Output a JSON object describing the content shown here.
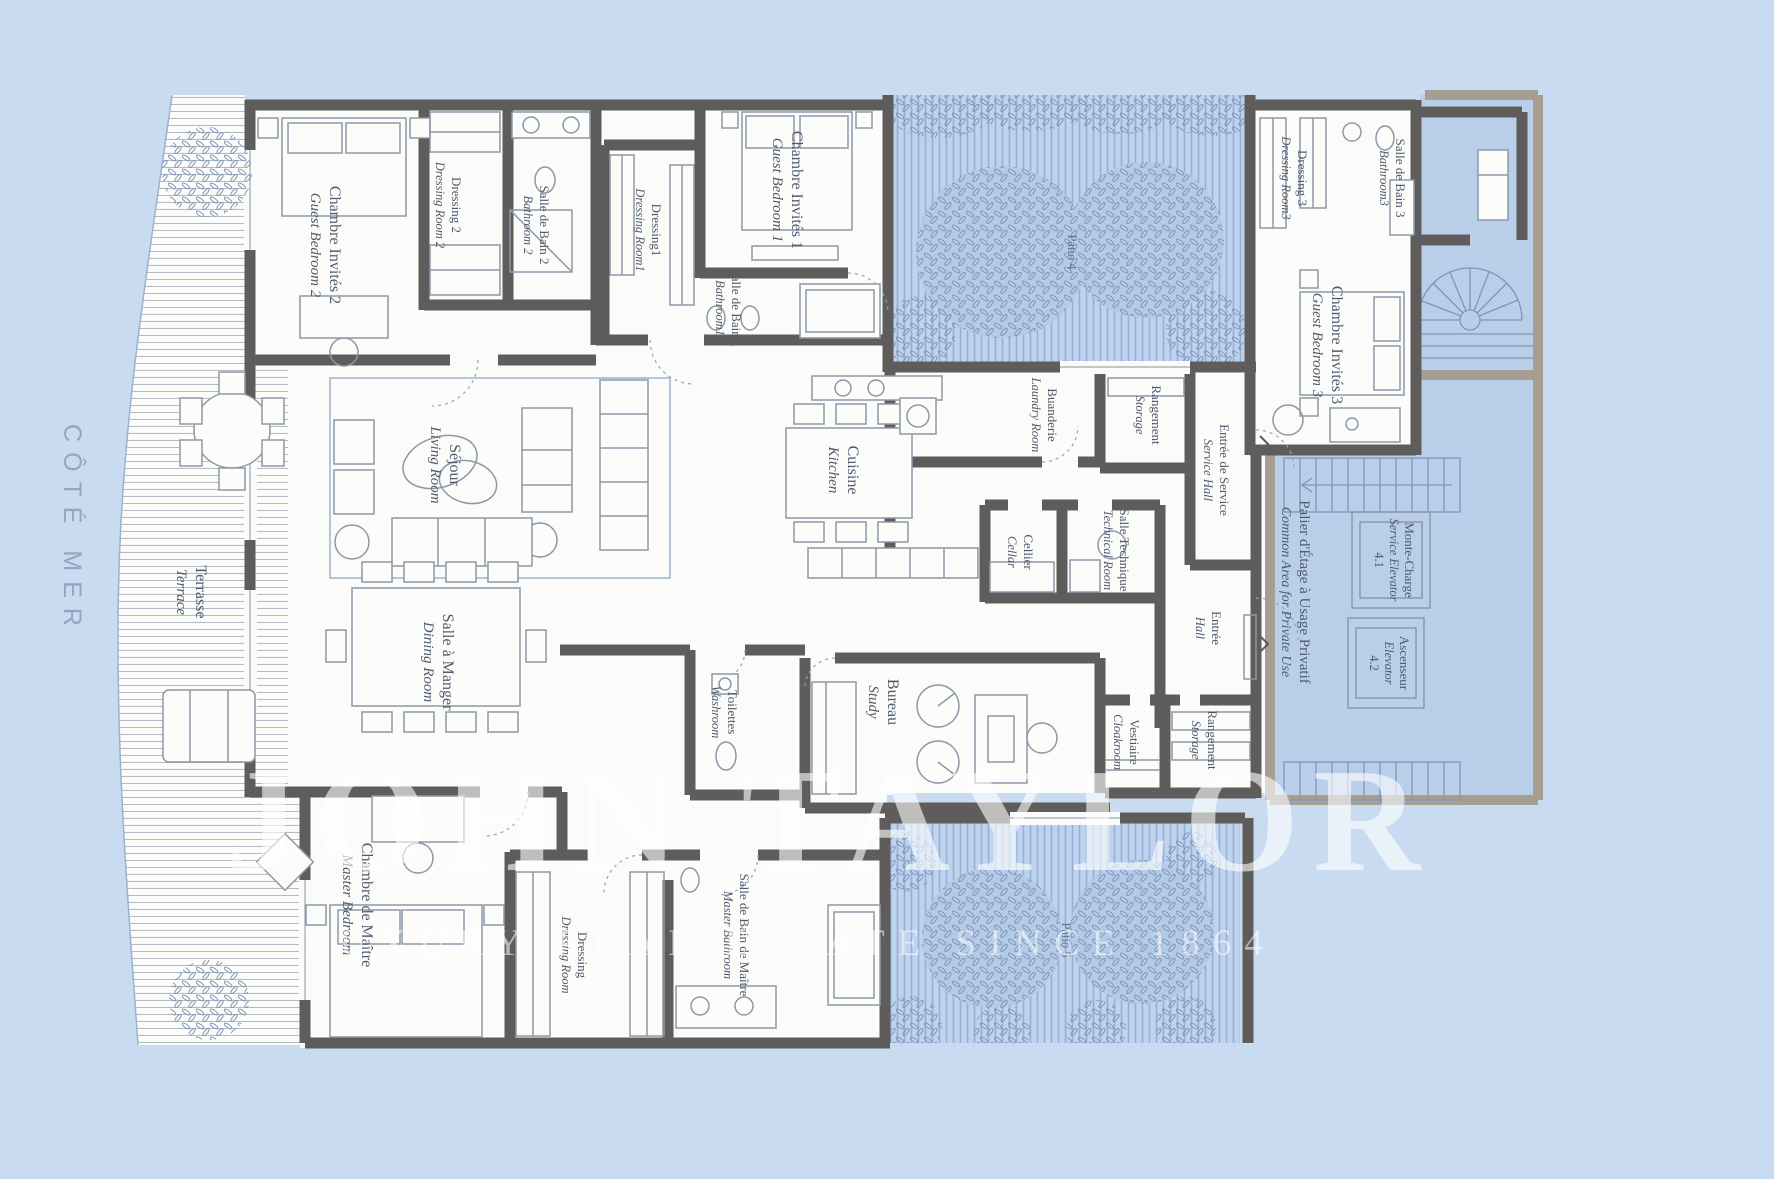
{
  "side_label": "CÔTÉ MER",
  "watermark": {
    "brand": "JOHN TAYLOR",
    "tagline": "LUXURY REAL ESTATE SINCE 1864"
  },
  "terrace": {
    "fr": "Terrasse",
    "en": "Terrace"
  },
  "patios": [
    {
      "label": "Patio 4"
    },
    {
      "label": "Patio 5"
    }
  ],
  "common_area": {
    "fr": "Palier d'Étage à Usage Privatif",
    "en": "Common Area for Private Use"
  },
  "elevators": [
    {
      "fr": "Monte-Charge",
      "en": "Service Elevator",
      "number": "4.1"
    },
    {
      "fr": "Ascenseur",
      "en": "Elevator",
      "number": "4.2"
    }
  ],
  "rooms": [
    {
      "fr": "Chambre Invités 2",
      "en": "Guest Bedroom 2"
    },
    {
      "fr": "Dressing 2",
      "en": "Dressing Room 2"
    },
    {
      "fr": "Salle de Bain 2",
      "en": "Bathroom 2"
    },
    {
      "fr": "Dressing1",
      "en": "Dressing Room1"
    },
    {
      "fr": "Chambre Invités 1",
      "en": "Guest Bedroom 1"
    },
    {
      "fr": "Salle de Bain 1",
      "en": "Bathroom1"
    },
    {
      "fr": "Dressing 3",
      "en": "Dressing Room3"
    },
    {
      "fr": "Salle de Bain 3",
      "en": "Bathroom3"
    },
    {
      "fr": "Chambre Invités 3",
      "en": "Guest Bedroom 3"
    },
    {
      "fr": "Séjour",
      "en": "Living Room"
    },
    {
      "fr": "Cuisine",
      "en": "Kitchen"
    },
    {
      "fr": "Buanderie",
      "en": "Laundry Room"
    },
    {
      "fr": "Rangement",
      "en": "Storage"
    },
    {
      "fr": "Entrée de Service",
      "en": "Service Hall"
    },
    {
      "fr": "Cellier",
      "en": "Cellar"
    },
    {
      "fr": "Salle Technique",
      "en": "Technical Room"
    },
    {
      "fr": "Entrée",
      "en": "Hall"
    },
    {
      "fr": "Toilettes",
      "en": "Washroom"
    },
    {
      "fr": "Bureau",
      "en": "Study"
    },
    {
      "fr": "Salle à Manger",
      "en": "Dining Room"
    },
    {
      "fr": "Chambre de Maître",
      "en": "Master Bedroom"
    },
    {
      "fr": "Dressing",
      "en": "Dressing Room"
    },
    {
      "fr": "Salle de Bain de Maître",
      "en": "Master Bathroom"
    },
    {
      "fr": "Vestiaire",
      "en": "Cloakroom"
    },
    {
      "fr": "Rangement",
      "en": "Storage"
    }
  ],
  "colors": {
    "background": "#C8DBF0",
    "room_fill": "#FBFBF9",
    "wall_dark": "#5E5D5B",
    "wall_common": "#A59E91",
    "patio_fill": "#BED4EE",
    "patio_stripe": "#96AED2",
    "common_fill": "#B9CFE9",
    "label_text": "#4F5B6D",
    "watermark": "rgba(255,255,255,0.6)"
  }
}
